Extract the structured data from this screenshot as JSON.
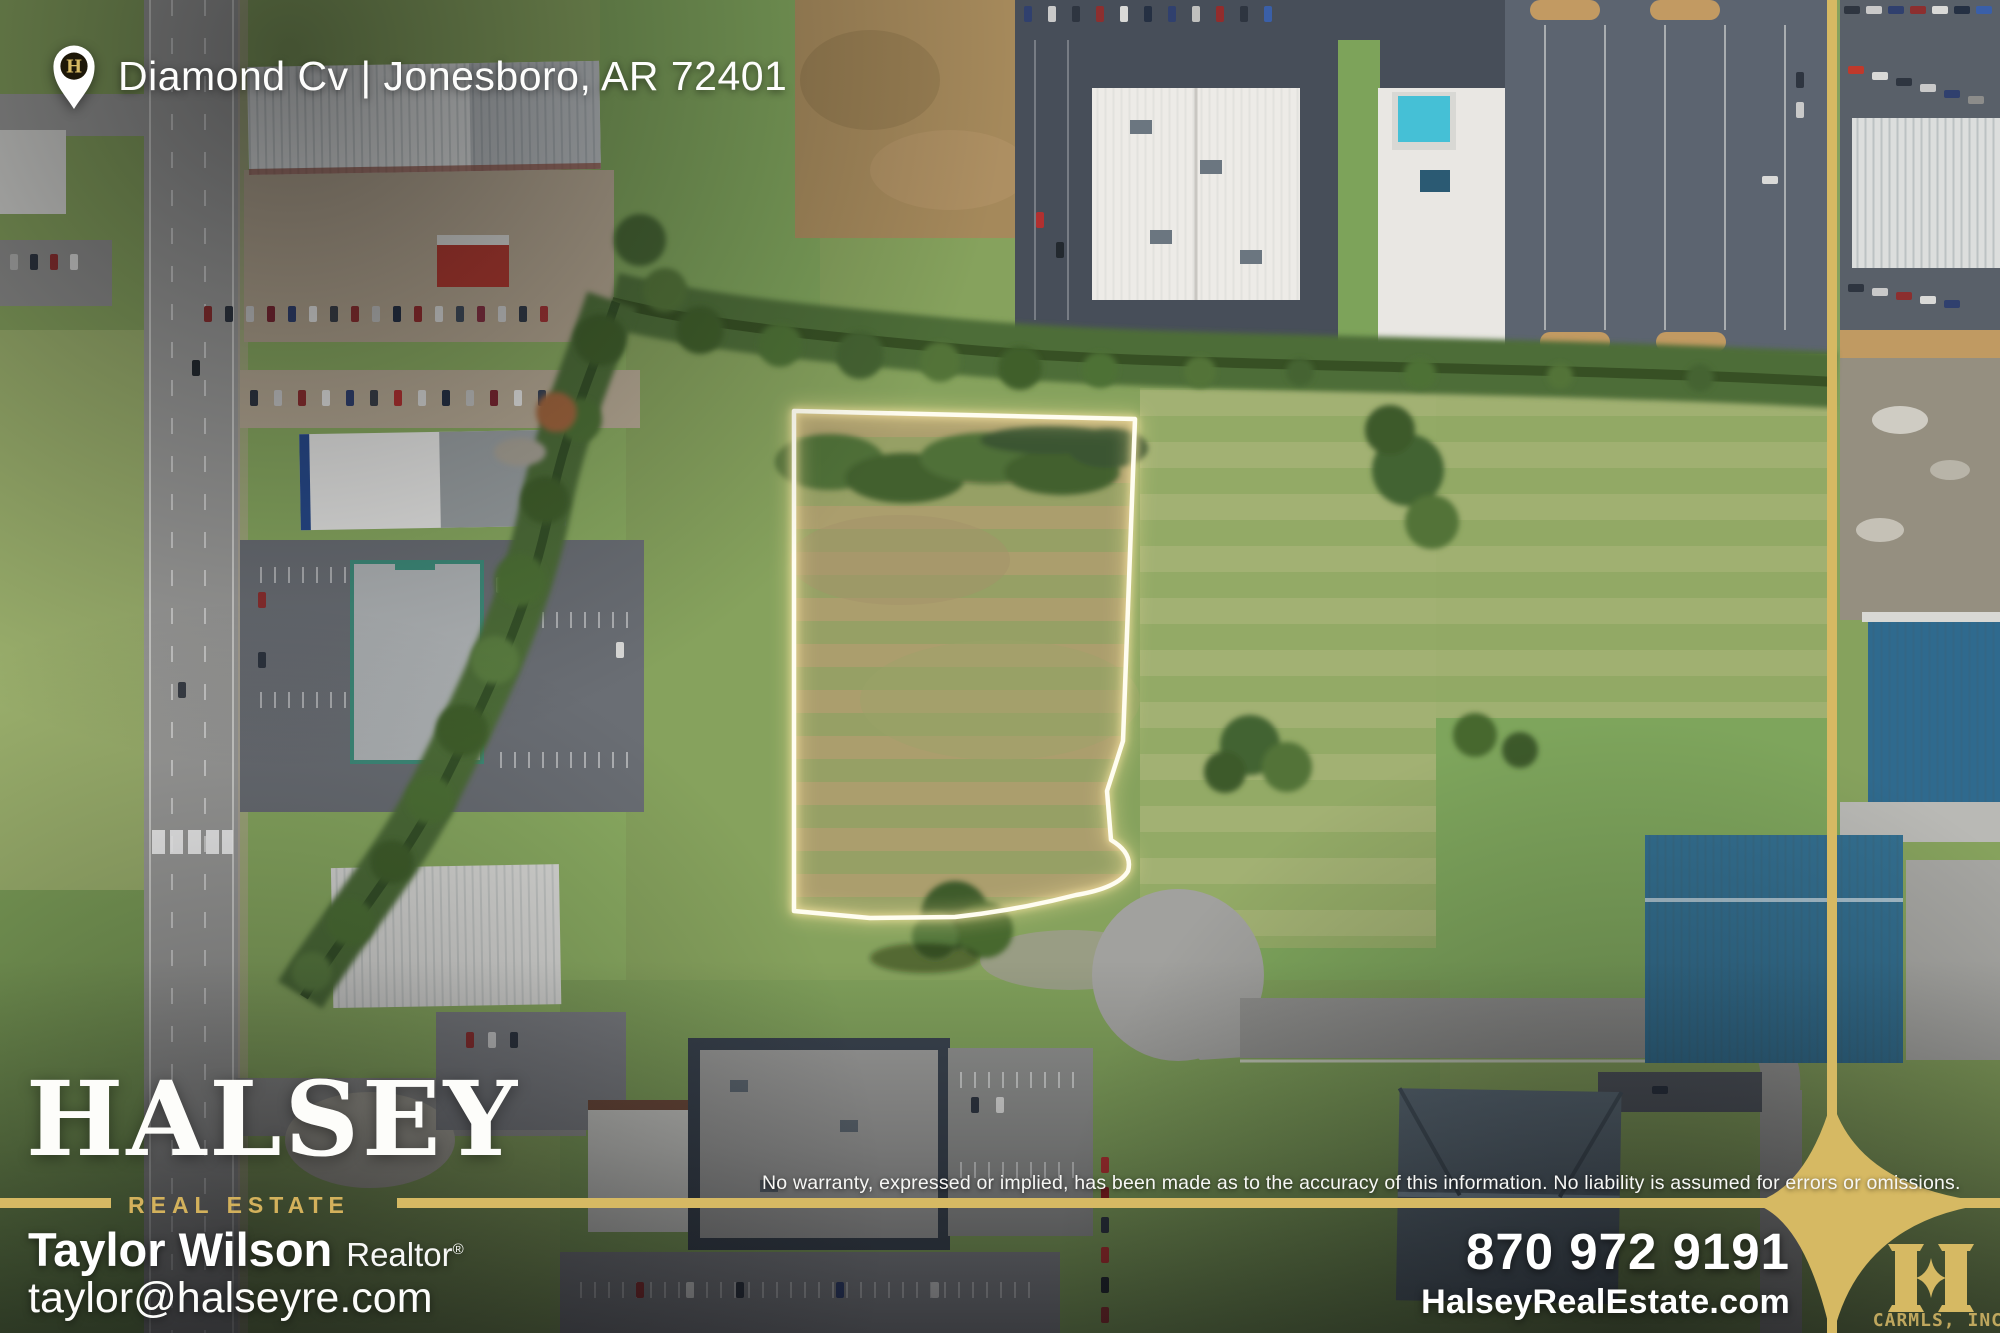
{
  "location": {
    "address": "Diamond Cv | Jonesboro, AR 72401"
  },
  "brand": {
    "name": "HALSEY",
    "tagline": "REAL ESTATE"
  },
  "agent": {
    "name": "Taylor Wilson",
    "title": "Realtor",
    "trademark": "®",
    "email": "taylor@halseyre.com"
  },
  "footer": {
    "disclaimer": "No warranty, expressed or implied, has been made as to the accuracy of this information. No liability is assumed for errors or omissions."
  },
  "contact": {
    "phone": "870 972 9191",
    "website": "HalseyRealEstate.com"
  },
  "watermark": {
    "monogram": "H",
    "mls": "CARMLS, INC"
  },
  "colors": {
    "gold": "#d6b963",
    "outline_glow": "#fffdf0",
    "pin_circle": "#1d1708"
  }
}
